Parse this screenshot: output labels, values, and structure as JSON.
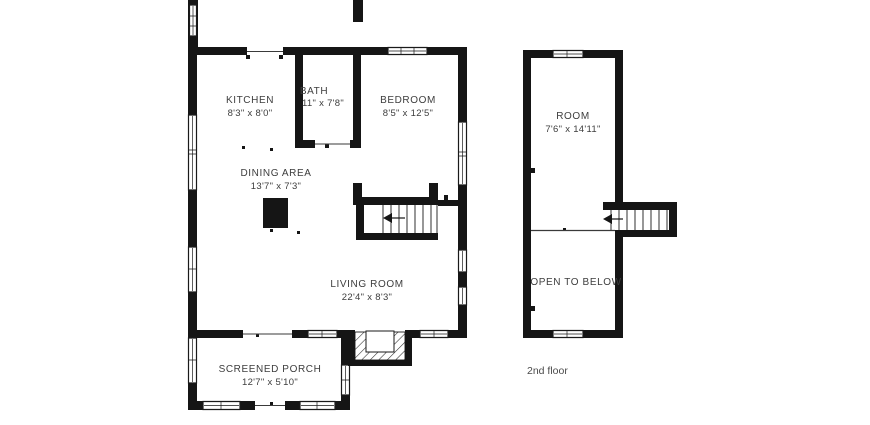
{
  "floor1": {
    "rooms": {
      "kitchen": {
        "name": "KITCHEN",
        "dims": "8'3\" x 8'0\""
      },
      "bath": {
        "name": "BATH",
        "dims": "11\" x 7'8\""
      },
      "bedroom": {
        "name": "BEDROOM",
        "dims": "8'5\" x 12'5\""
      },
      "dining": {
        "name": "DINING AREA",
        "dims": "13'7\" x 7'3\""
      },
      "living": {
        "name": "LIVING ROOM",
        "dims": "22'4\" x 8'3\""
      },
      "porch": {
        "name": "SCREENED PORCH",
        "dims": "12'7\" x 5'10\""
      }
    }
  },
  "floor2": {
    "rooms": {
      "room": {
        "name": "ROOM",
        "dims": "7'6\" x 14'11\""
      },
      "open_to_below": {
        "name": "OPEN TO BELOW"
      }
    },
    "caption": "2nd floor"
  },
  "colors": {
    "wall": "#151515",
    "background": "#ffffff",
    "room_text": "#3d3d3d",
    "caption_text": "#4a4a4a"
  }
}
